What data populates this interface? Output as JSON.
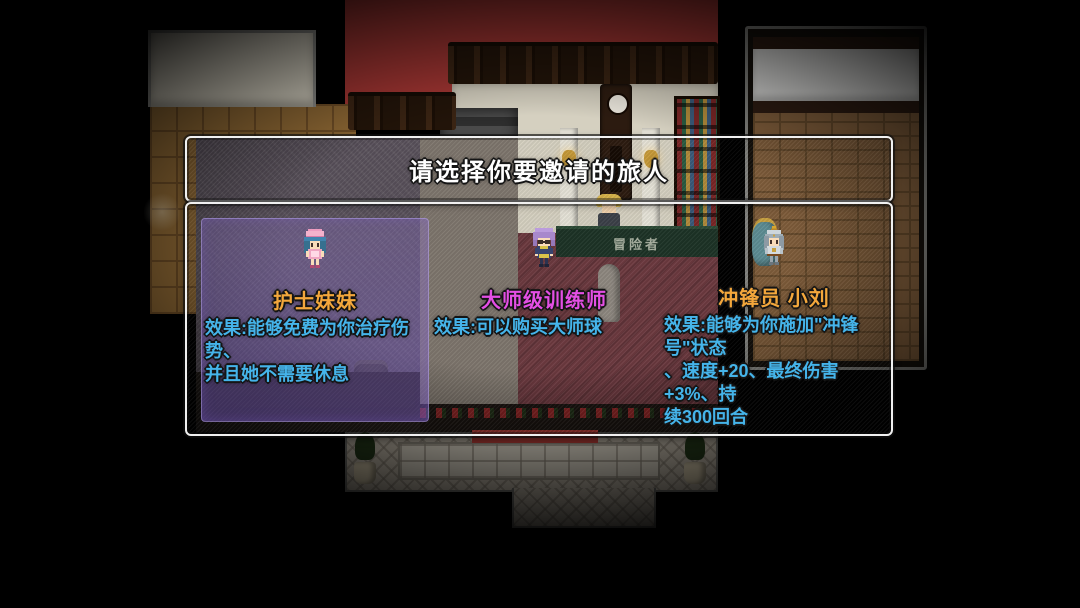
{
  "dialog": {
    "title": "请选择你要邀请的旅人",
    "desc_color": "#45b4ea",
    "highlight_color": "#8d74d6",
    "options": [
      {
        "id": "nurse",
        "name": "护士妹妹",
        "name_color": "#f3a73c",
        "selected": true,
        "sprite": "nurse-sprite",
        "desc_lines": [
          "效果:能够免费为你治疗伤势、",
          "并且她不需要休息"
        ]
      },
      {
        "id": "master-trainer",
        "name": "大师级训练师",
        "name_color": "#e44fe4",
        "selected": false,
        "sprite": "trainer-sprite",
        "desc_lines": [
          "效果:可以购买大师球"
        ]
      },
      {
        "id": "charger-xiaoliu",
        "name": "冲锋员 小刘",
        "name_color": "#f3a73c",
        "selected": false,
        "sprite": "knight-sprite",
        "desc_lines": [
          "效果:能够为你施加\"冲锋号\"状态",
          "、速度+20、最终伤害+3%、持",
          "续300回合"
        ]
      }
    ]
  },
  "scene": {
    "counter_sign": "冒险者"
  }
}
